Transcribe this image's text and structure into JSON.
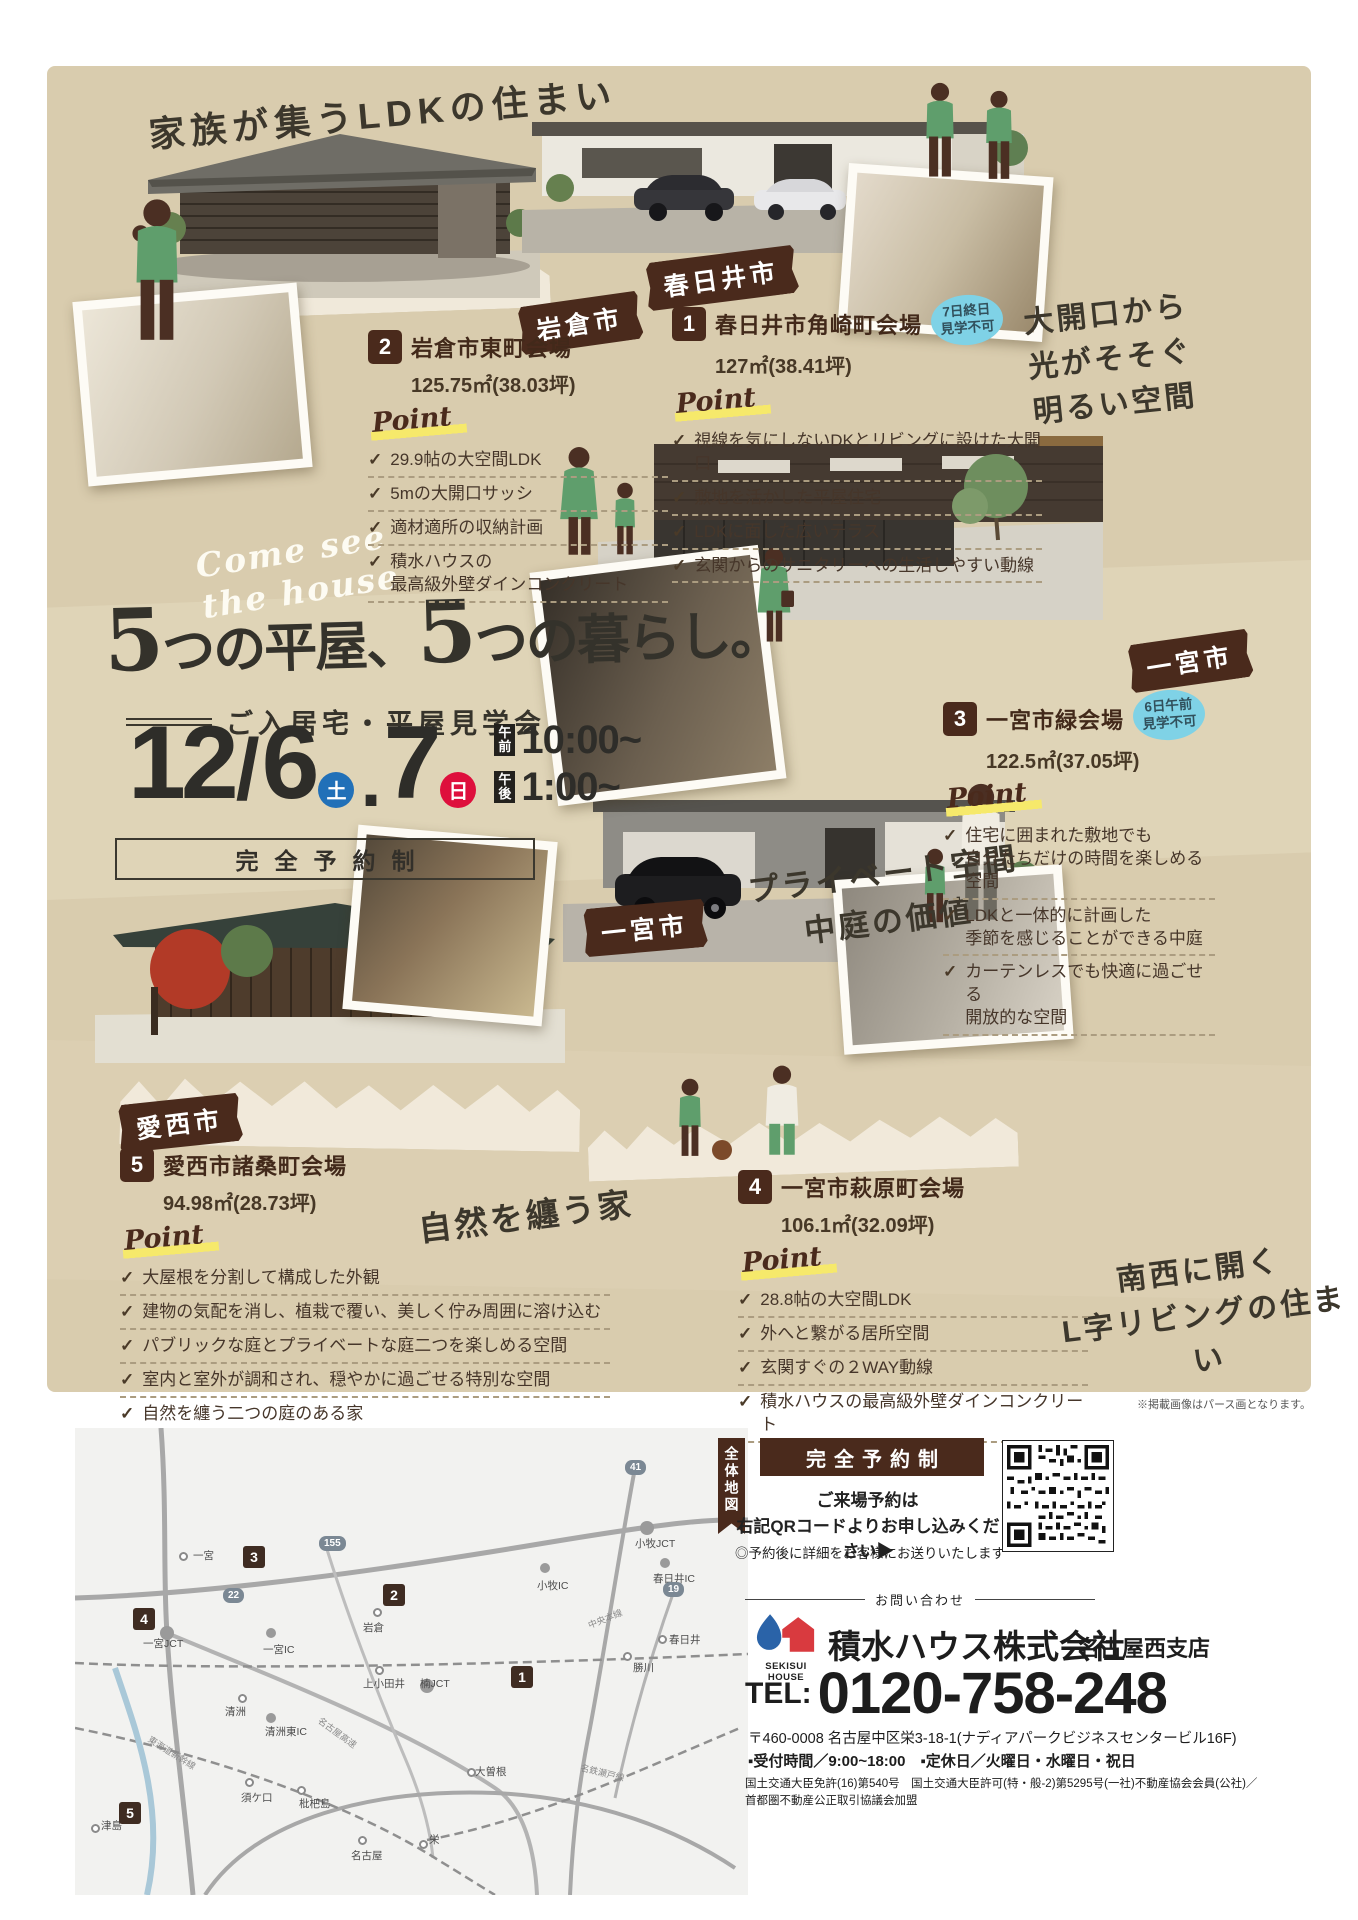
{
  "headline": "家族が集うLDKの住まい",
  "hero": {
    "come_see": "Come see\nthe house",
    "title_n1": "5",
    "title_t1": "つの平屋、",
    "title_n2": "5",
    "title_t2": "つの暮らし。",
    "subtitle": "ご入居宅・平屋見学会",
    "date_main": "12",
    "date_slash": "/",
    "date_d1": "6",
    "date_sat": "土",
    "date_dot": ".",
    "date_d2": "7",
    "date_sun": "日",
    "am_label": "午前",
    "am_time": "10:00~",
    "pm_label": "午後",
    "pm_time": "1:00~",
    "reservation": "完全予約制"
  },
  "venues": [
    {
      "no": "1",
      "tape": "春日井市",
      "name": "春日井市角崎町会場",
      "area": "127㎡(38.41坪)",
      "badge": "7日終日\n見学不可",
      "point": "Point",
      "points": [
        "視線を気にしないDKとリビングに設けた大開口",
        "敷地を活かした平屋住宅",
        "LDKに面した広いテラス",
        "玄関からのサニタリーへの生活しやすい動線"
      ],
      "note": "大開口から\n光がそそぐ\n明るい空間"
    },
    {
      "no": "2",
      "tape": "岩倉市",
      "name": "岩倉市東町会場",
      "area": "125.75㎡(38.03坪)",
      "point": "Point",
      "points": [
        "29.9帖の大空間LDK",
        "5mの大開口サッシ",
        "適材適所の収納計画",
        "積水ハウスの\n最高級外壁ダインコンクリート"
      ]
    },
    {
      "no": "3",
      "tape": "一宮市",
      "name": "一宮市緑会場",
      "area": "122.5㎡(37.05坪)",
      "badge": "6日午前\n見学不可",
      "point": "Point",
      "points": [
        "住宅に囲まれた敷地でも\n自分たちだけの時間を楽しめる空間",
        "LDKと一体的に計画した\n季節を感じることができる中庭",
        "カーテンレスでも快適に過ごせる\n開放的な空間"
      ],
      "note": "プライベート空間\n中庭の価値"
    },
    {
      "no": "4",
      "tape": "一宮市",
      "name": "一宮市萩原町会場",
      "area": "106.1㎡(32.09坪)",
      "point": "Point",
      "points": [
        "28.8帖の大空間LDK",
        "外へと繋がる居所空間",
        "玄関すぐの２WAY動線",
        "積水ハウスの最高級外壁ダインコンクリート"
      ],
      "note": "南西に開く\nL字リビングの住まい"
    },
    {
      "no": "5",
      "tape": "愛西市",
      "name": "愛西市諸桑町会場",
      "area": "94.98㎡(28.73坪)",
      "point": "Point",
      "points": [
        "大屋根を分割して構成した外観",
        "建物の気配を消し、植栽で覆い、美しく佇み周囲に溶け込む",
        "パブリックな庭とプライベートな庭二つを楽しめる空間",
        "室内と室外が調和され、穏やかに過ごせる特別な空間",
        "自然を纏う二つの庭のある家"
      ],
      "note": "自然を纏う家"
    }
  ],
  "disclaimer": "※掲載画像はパース画となります。",
  "map": {
    "tab": "全体地図",
    "labels": [
      "一宮",
      "一宮JCT",
      "一宮IC",
      "岩倉",
      "小牧IC",
      "小牧JCT",
      "春日井IC",
      "春日井",
      "勝川",
      "上小田井",
      "清洲",
      "清洲東IC",
      "楠JCT",
      "須ケ口",
      "枇杷島",
      "大曽根",
      "名古屋",
      "栄",
      "津島"
    ],
    "shields": [
      "41",
      "155",
      "22",
      "19"
    ],
    "roads": [
      "中央本線",
      "名鉄瀬戸線",
      "東海道新幹線",
      "名古屋高速"
    ],
    "markers": [
      "1",
      "2",
      "3",
      "4",
      "5"
    ]
  },
  "booking": {
    "box": "完全予約制",
    "line1": "ご来場予約は",
    "line2": "右記QRコードよりお申し込みください▶",
    "note": "◎予約後に詳細をお客様にお送りいたします"
  },
  "contact": {
    "label": "お問い合わせ",
    "logo": "SEKISUI HOUSE",
    "company": "積水ハウス株式会社",
    "branch": "名古屋西支店",
    "tel_label": "TEL:",
    "tel": "0120-758-248",
    "address": "〒460-0008 名古屋中区栄3-18-1(ナディアパークビジネスセンタービル16F)",
    "hours": "▪受付時間／9:00~18:00　▪定休日／火曜日・水曜日・祝日",
    "license": "国土交通大臣免許(16)第540号　国土交通大臣許可(特・般-2)第5295号(一社)不動産協会会員(公社)／\n首都圏不動産公正取引協議会加盟"
  }
}
